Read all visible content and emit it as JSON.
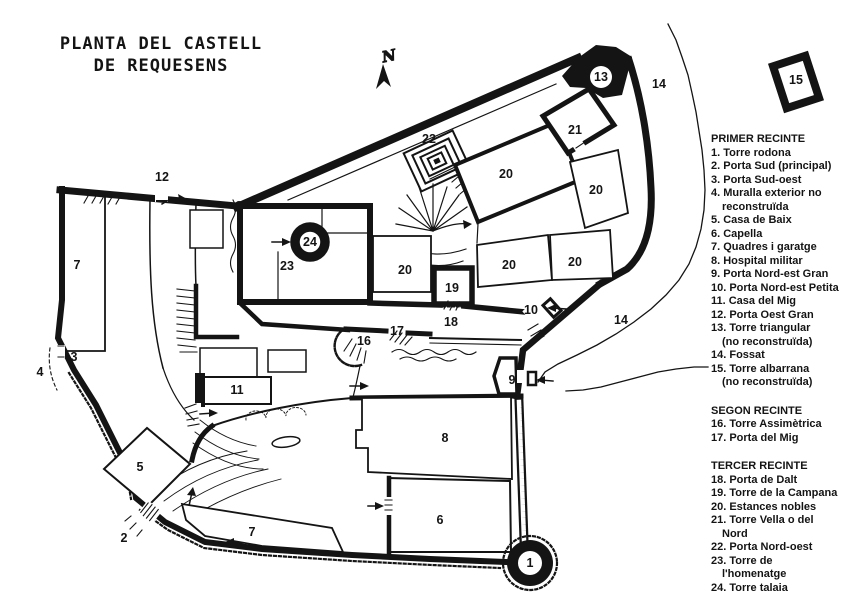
{
  "title": {
    "line1": "PLANTA DEL CASTELL",
    "line2": "DE REQUESENS"
  },
  "north": {
    "label": "N"
  },
  "colors": {
    "ink": "#141414",
    "paper": "#ffffff"
  },
  "legend": {
    "sections": [
      {
        "heading": "PRIMER RECINTE",
        "items": [
          "1. Torre rodona",
          "2. Porta Sud (principal)",
          "3. Porta Sud-oest",
          "4. Muralla exterior no\nreconstruïda",
          "5. Casa de Baix",
          "6. Capella",
          "7. Quadres i garatge",
          "8. Hospital militar",
          "9. Porta Nord-est Gran",
          "10. Porta Nord-est Petita",
          "11. Casa del Mig",
          "12. Porta Oest Gran",
          "13. Torre triangular\n(no reconstruïda)",
          "14. Fossat",
          "15. Torre albarrana\n(no reconstruïda)"
        ]
      },
      {
        "heading": "SEGON RECINTE",
        "items": [
          "16. Torre Assimètrica",
          "17. Porta del Mig"
        ]
      },
      {
        "heading": "TERCER RECINTE",
        "items": [
          "18. Porta de Dalt",
          "19. Torre de la Campana",
          "20. Estances nobles",
          "21. Torre Vella o del\nNord",
          "22. Porta Nord-oest",
          "23. Torre de\nl'homenatge",
          "24. Torre talaia"
        ]
      }
    ]
  },
  "map": {
    "labels": [
      {
        "text": "13",
        "x": 601,
        "y": 77
      },
      {
        "text": "14",
        "x": 659,
        "y": 84
      },
      {
        "text": "15",
        "x": 796,
        "y": 80
      },
      {
        "text": "22",
        "x": 429,
        "y": 139
      },
      {
        "text": "21",
        "x": 575,
        "y": 130
      },
      {
        "text": "20",
        "x": 506,
        "y": 174
      },
      {
        "text": "20",
        "x": 596,
        "y": 190
      },
      {
        "text": "12",
        "x": 162,
        "y": 177
      },
      {
        "text": "24",
        "x": 310,
        "y": 242
      },
      {
        "text": "23",
        "x": 287,
        "y": 266
      },
      {
        "text": "20",
        "x": 405,
        "y": 270
      },
      {
        "text": "20",
        "x": 509,
        "y": 265
      },
      {
        "text": "20",
        "x": 575,
        "y": 262
      },
      {
        "text": "19",
        "x": 452,
        "y": 288
      },
      {
        "text": "10",
        "x": 531,
        "y": 310
      },
      {
        "text": "14",
        "x": 621,
        "y": 320
      },
      {
        "text": "18",
        "x": 451,
        "y": 322
      },
      {
        "text": "17",
        "x": 397,
        "y": 331
      },
      {
        "text": "16",
        "x": 364,
        "y": 341
      },
      {
        "text": "7",
        "x": 77,
        "y": 265
      },
      {
        "text": "3",
        "x": 74,
        "y": 357
      },
      {
        "text": "4",
        "x": 40,
        "y": 372
      },
      {
        "text": "9",
        "x": 512,
        "y": 380
      },
      {
        "text": "11",
        "x": 237,
        "y": 390
      },
      {
        "text": "5",
        "x": 140,
        "y": 467
      },
      {
        "text": "2",
        "x": 124,
        "y": 538
      },
      {
        "text": "7",
        "x": 252,
        "y": 532
      },
      {
        "text": "8",
        "x": 445,
        "y": 438
      },
      {
        "text": "6",
        "x": 440,
        "y": 520
      },
      {
        "text": "1",
        "x": 530,
        "y": 563
      }
    ]
  }
}
